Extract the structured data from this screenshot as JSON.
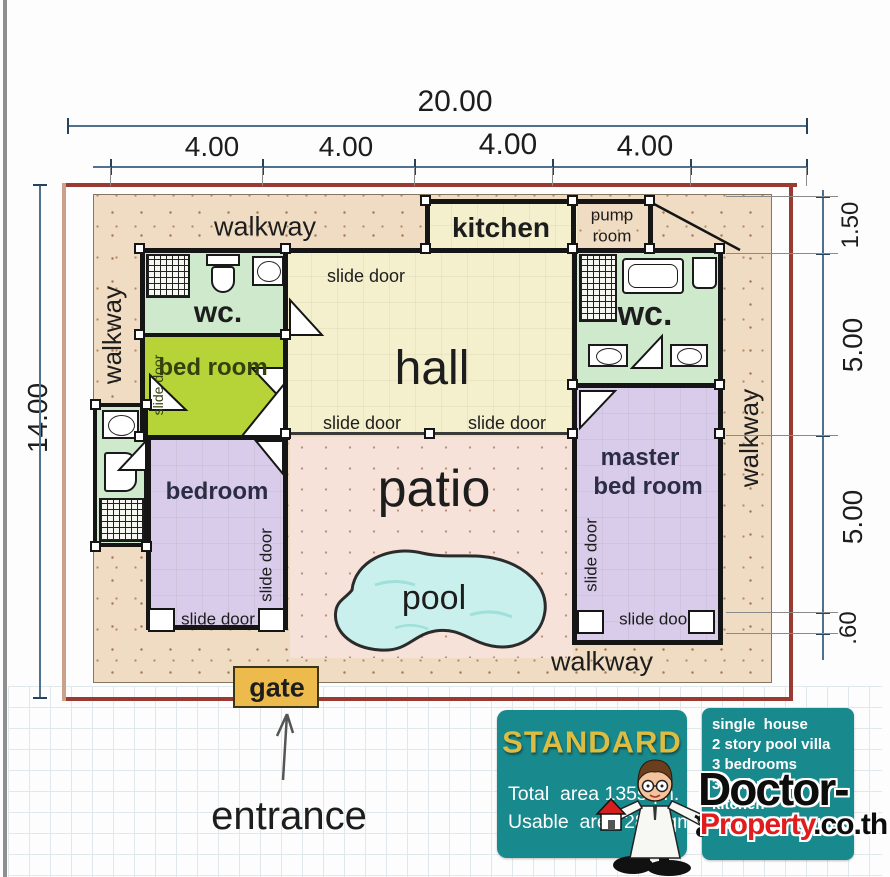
{
  "dimensions": {
    "top_total": "20.00",
    "top_segments": [
      "4.00",
      "4.00",
      "4.00",
      "4.00"
    ],
    "left_height": "14.00",
    "right_segments": [
      "1.50",
      "5.00",
      "5.00",
      ".60"
    ]
  },
  "labels": {
    "walkway": "walkway",
    "kitchen": "kitchen",
    "pump_room_line1": "pump",
    "pump_room_line2": "room",
    "wc": "wc.",
    "bed_room": "bed room",
    "hall": "hall",
    "bedroom": "bedroom",
    "master_line1": "master",
    "master_line2": "bed room",
    "patio": "patio",
    "pool": "pool",
    "slide_door": "slide door",
    "gate": "gate",
    "entrance": "entrance"
  },
  "info_card": {
    "grade": "STANDARD",
    "total_area": "Total  area 135sqm.",
    "usable_area": "Usable  area 280sqm."
  },
  "features_card": {
    "items": [
      "single  house",
      "2 story pool villa",
      "3 bedrooms",
      "3 bathrooms",
      "kitchen",
      "swimming pool 5x3m."
    ]
  },
  "brand": {
    "name_part1": "Doctor-",
    "name_part2": "Property",
    "name_part3": ".co.th"
  },
  "colors": {
    "teal_card": "#18898d",
    "gold_text": "#dcbd42",
    "boundary_red": "#9b3a33",
    "walkway_beige": "#f0dcc2",
    "hall_cream": "#f4f0cd",
    "wc_mint": "#cfe9cd",
    "bed_room_lime": "#b6d438",
    "bedroom_purple": "#d8ccea",
    "patio_pink": "#f6e2d8",
    "pool_blue": "#c9f0ec",
    "gate_orange": "#edba4c"
  }
}
